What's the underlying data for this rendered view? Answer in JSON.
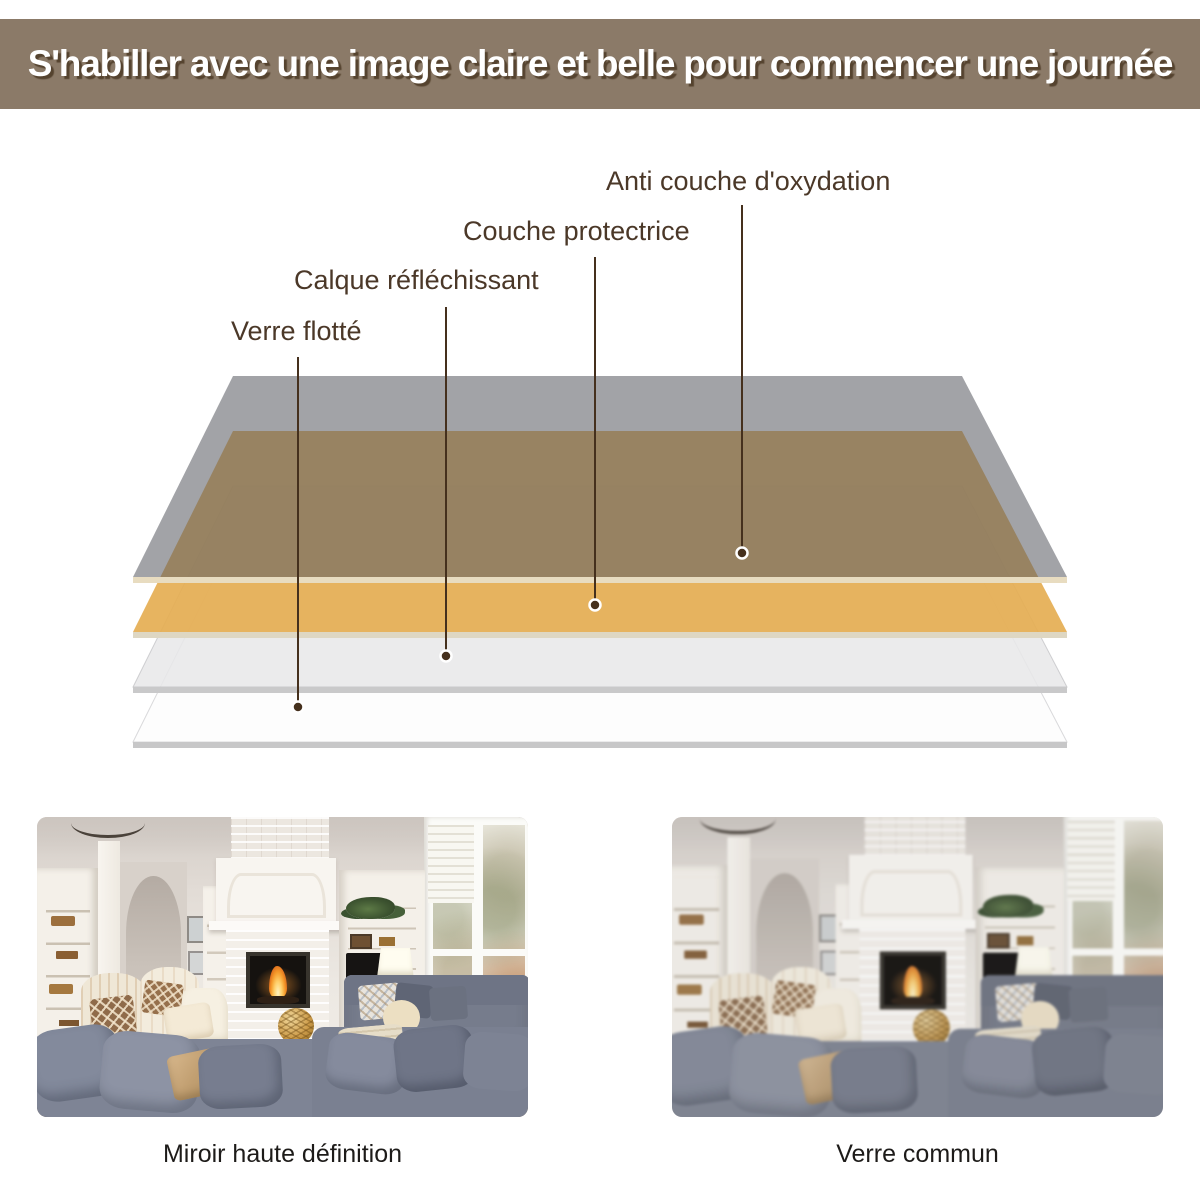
{
  "banner": {
    "text": "S'habiller avec une image claire et belle pour commencer une journée",
    "bg_color": "#8b7a68",
    "text_color": "#ffffff"
  },
  "diagram": {
    "labels": [
      {
        "text": "Anti couche d'oxydation"
      },
      {
        "text": "Couche protectrice"
      },
      {
        "text": "Calque réfléchissant"
      },
      {
        "text": "Verre flotté"
      }
    ],
    "layers": [
      {
        "name": "anti-oxidation-layer",
        "fill": "rgba(92,94,101,0.57)",
        "edge": "#e8dcc0"
      },
      {
        "name": "protective-layer",
        "fill": "rgba(229,174,83,0.92)",
        "edge": "#ded7c3"
      },
      {
        "name": "reflective-layer",
        "fill": "rgba(231,231,233,0.85)",
        "edge": "#c9c9ca"
      },
      {
        "name": "float-glass",
        "fill": "#fdfdfd",
        "edge": "#c7c7c8"
      }
    ],
    "line_color": "#45301d"
  },
  "comparison": {
    "left_caption": "Miroir haute définition",
    "right_caption": "Verre commun"
  }
}
